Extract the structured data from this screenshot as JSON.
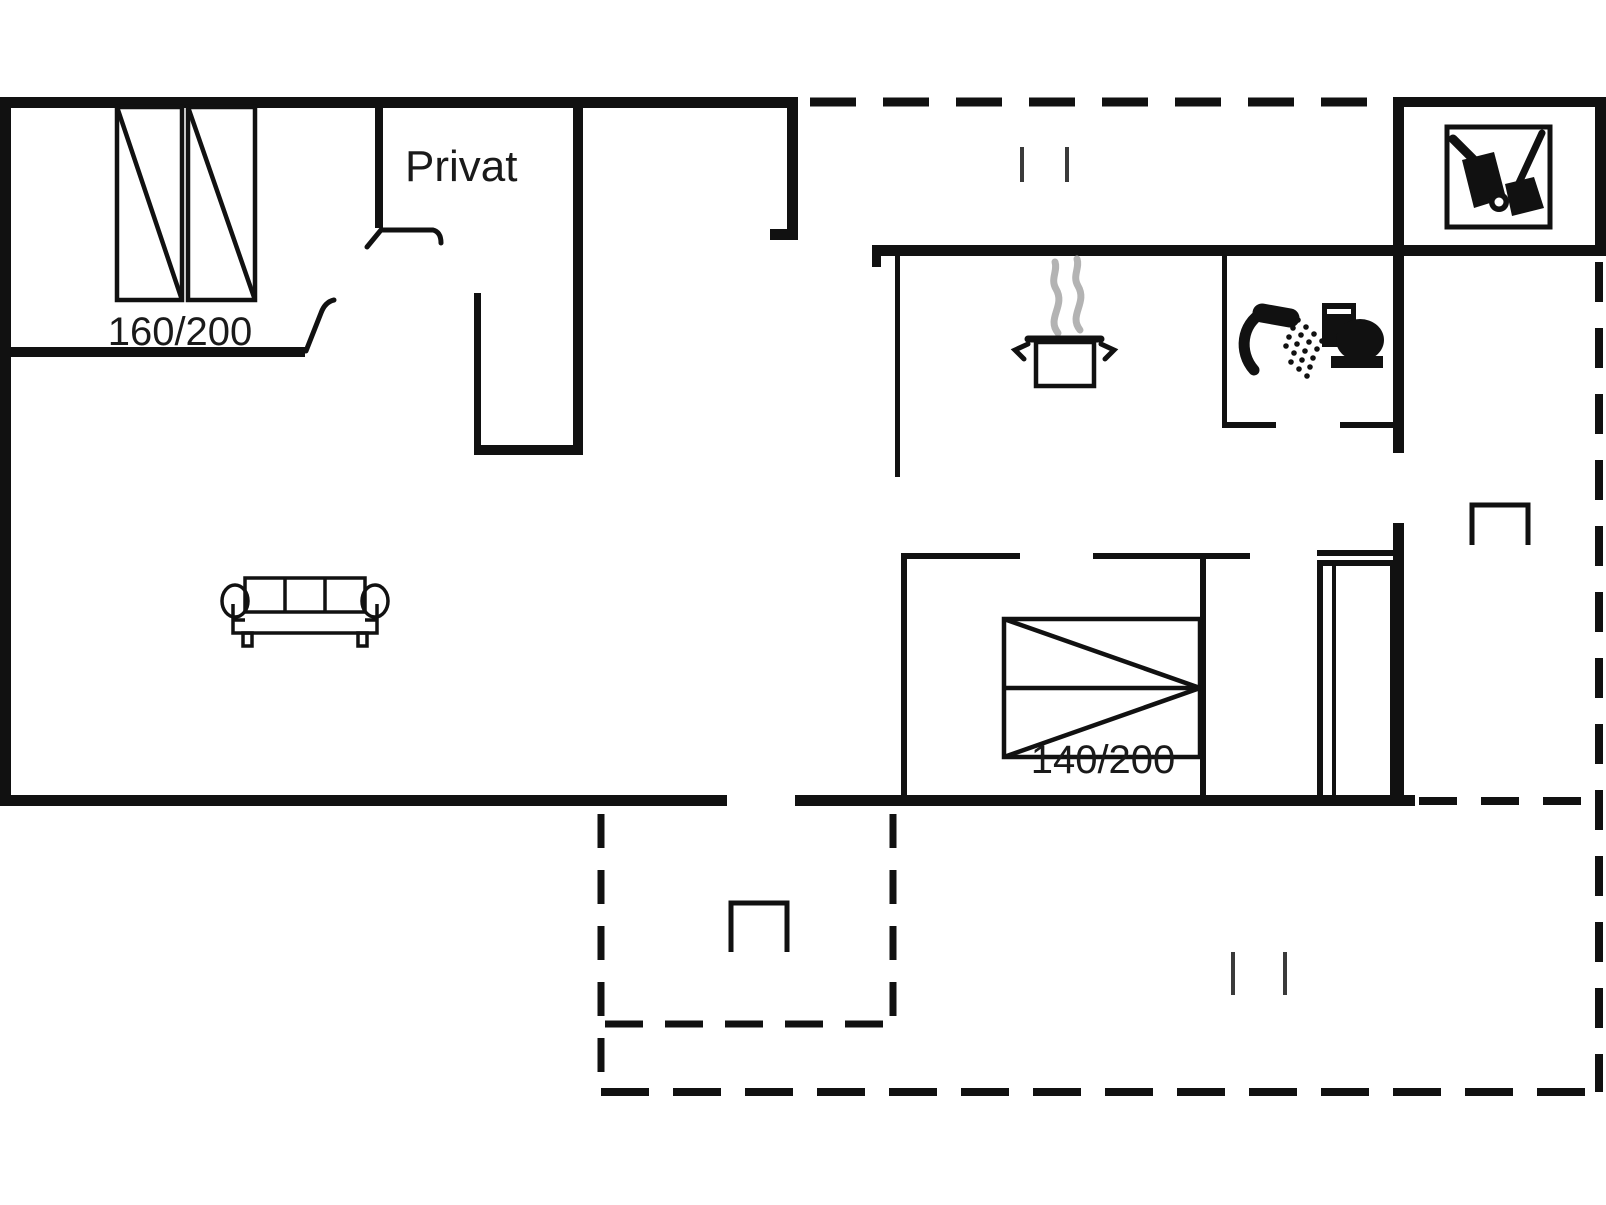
{
  "title": "Holiday house floor plan",
  "colors": {
    "line": "#111111",
    "steam": "#b3b3b3",
    "window_mark": "#3a3a3a",
    "background": "#ffffff"
  },
  "labels": {
    "private_room": "Privat",
    "bed_left_size": "160/200",
    "bed_right_size": "140/200"
  },
  "icons": [
    "double-bed-160-icon",
    "double-bed-140-icon",
    "sofa-icon",
    "cooking-pot-icon",
    "steam-icon",
    "shower-icon",
    "toilet-icon",
    "vacuum-cleaner-icon",
    "broom-icon",
    "wardrobe-icon",
    "entrance-step-icon",
    "door-swing-icon",
    "sliding-door-marks-icon",
    "terrace-dashed-boundary"
  ]
}
